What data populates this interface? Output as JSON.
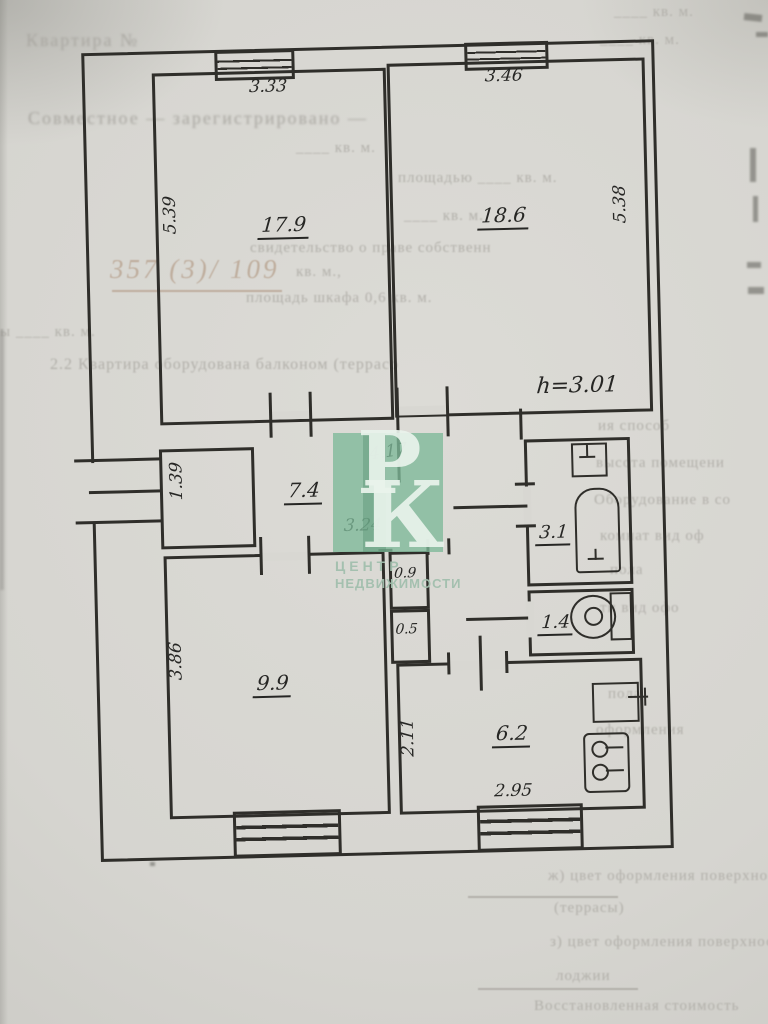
{
  "plan": {
    "rooms": {
      "room_tl": {
        "area": "17.9",
        "dim_top": "3.33",
        "dim_left": "5.39"
      },
      "room_tr": {
        "area": "18.6",
        "dim_top": "3.46",
        "dim_right": "5.38",
        "height_mark": "h=3.01"
      },
      "hall": {
        "area": "7.4",
        "dim_top": "4.17",
        "dim_bottom": "3.24"
      },
      "entry": {
        "dim": "1.39"
      },
      "bathroom": {
        "area": "3.1"
      },
      "wc": {
        "area": "1.4"
      },
      "closet_top": {
        "area": "0.9"
      },
      "closet_bottom": {
        "area": "0.5"
      },
      "room_bl": {
        "area": "9.9",
        "dim_left": "3.86"
      },
      "kitchen": {
        "area": "6.2",
        "dim_bottom": "2.95",
        "dim_left": "2.11"
      }
    }
  },
  "watermark": {
    "letter_top": "Р",
    "letter_bottom": "К",
    "caption_top": "ЦЕНТР",
    "caption_bottom": "НЕДВИЖИМОСТИ",
    "square_color": "#7eb998",
    "caption_color": "#a1bfad"
  },
  "background_text": {
    "items": [
      {
        "text": "____ кв. м."
      },
      {
        "text": "____ кв. м."
      },
      {
        "text": "Квартира №"
      },
      {
        "text": "Совместное — зарегистрировано —"
      },
      {
        "text": "____ кв. м."
      },
      {
        "text": "площадью ____ кв. м."
      },
      {
        "text": "____ кв. м."
      },
      {
        "text": "свидетельство о праве собственн"
      },
      {
        "text": "кв. м.,"
      },
      {
        "text": "357 (3)/ 109"
      },
      {
        "text": "площадь шкафа 0,6 кв. м."
      },
      {
        "text": "ы ____ кв. м."
      },
      {
        "text": "2.2  Квартира оборудована балконом (террасо"
      },
      {
        "text": "ия  способ"
      },
      {
        "text": "высота помещени"
      },
      {
        "text": "Оборудование в со"
      },
      {
        "text": "комнат  вид оф"
      },
      {
        "text": "пола"
      },
      {
        "text": "ти  вид офо"
      },
      {
        "text": "пола"
      },
      {
        "text": "оформления"
      },
      {
        "text": "ж) цвет  оформления  поверхности  балкона"
      },
      {
        "text": "(террасы)"
      },
      {
        "text": "з) цвет оформления поверхности"
      },
      {
        "text": "лоджии"
      },
      {
        "text": "Восстановленная стоимость"
      }
    ]
  }
}
